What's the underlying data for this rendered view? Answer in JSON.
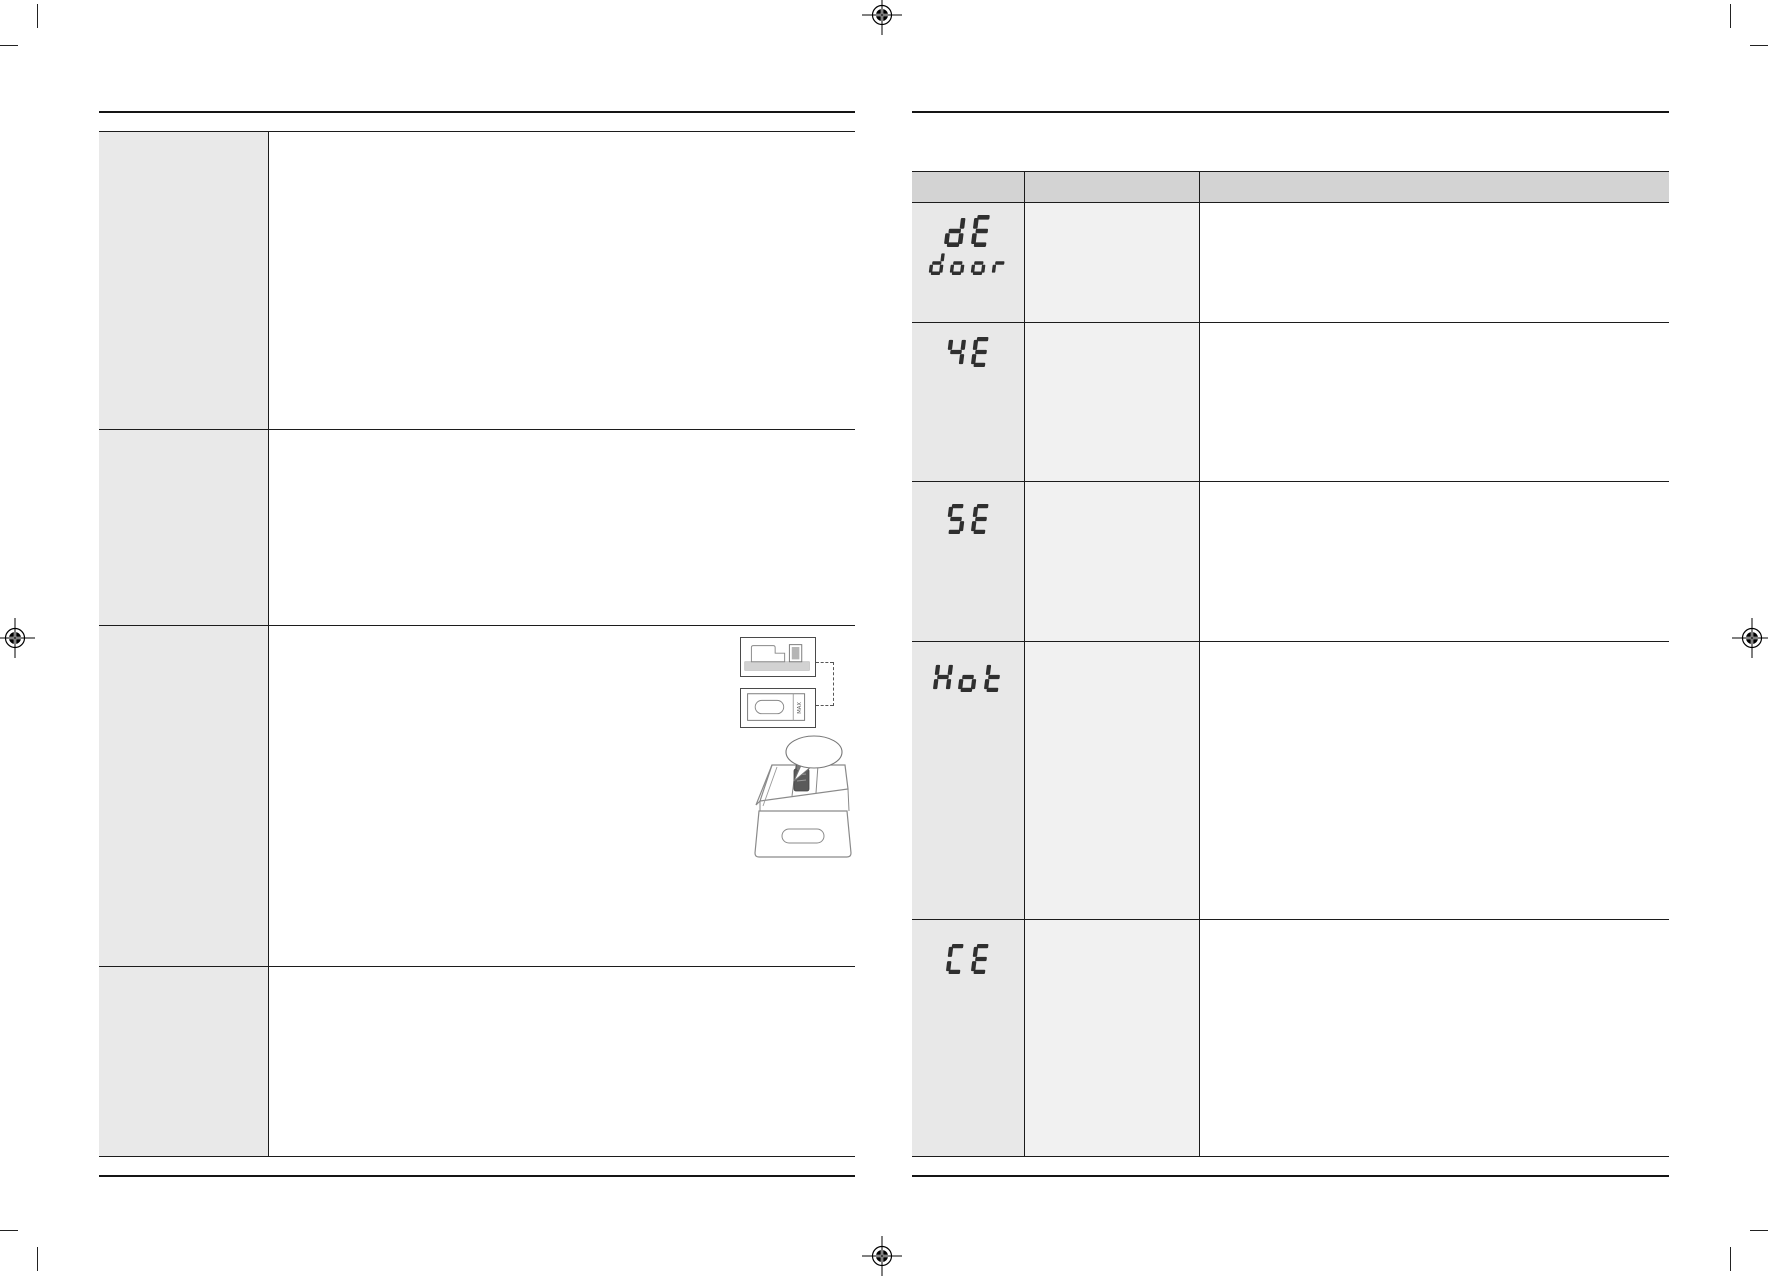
{
  "document": {
    "kind": "washing-machine manual troubleshooting spread",
    "background": "#ffffff"
  },
  "colors": {
    "border": "#1c1c1c",
    "rule": "#151515",
    "header_bg": "#d3d3d3",
    "code_column_bg": "#e8e8e8",
    "middle_column_bg": "#f1f1f1",
    "left_label_column_bg": "#e9e9e9",
    "glyph": "#2f2f2f"
  },
  "left_page": {
    "table": {
      "row_count": 4,
      "columns": 2,
      "rows": [
        {
          "label_text": "",
          "content_text": ""
        },
        {
          "label_text": "",
          "content_text": ""
        },
        {
          "label_text": "",
          "content_text": "",
          "has_illustrations": true
        },
        {
          "label_text": "",
          "content_text": ""
        }
      ]
    },
    "illustration": {
      "max_label": "MAX"
    }
  },
  "right_page": {
    "table": {
      "header_labels": [
        "",
        "",
        ""
      ],
      "rows": [
        {
          "code_lines": [
            "dE",
            "door"
          ]
        },
        {
          "code_lines": [
            "4E"
          ]
        },
        {
          "code_lines": [
            "5E"
          ]
        },
        {
          "code_lines": [
            "Hot"
          ]
        },
        {
          "code_lines": [
            "CE"
          ]
        }
      ]
    }
  }
}
